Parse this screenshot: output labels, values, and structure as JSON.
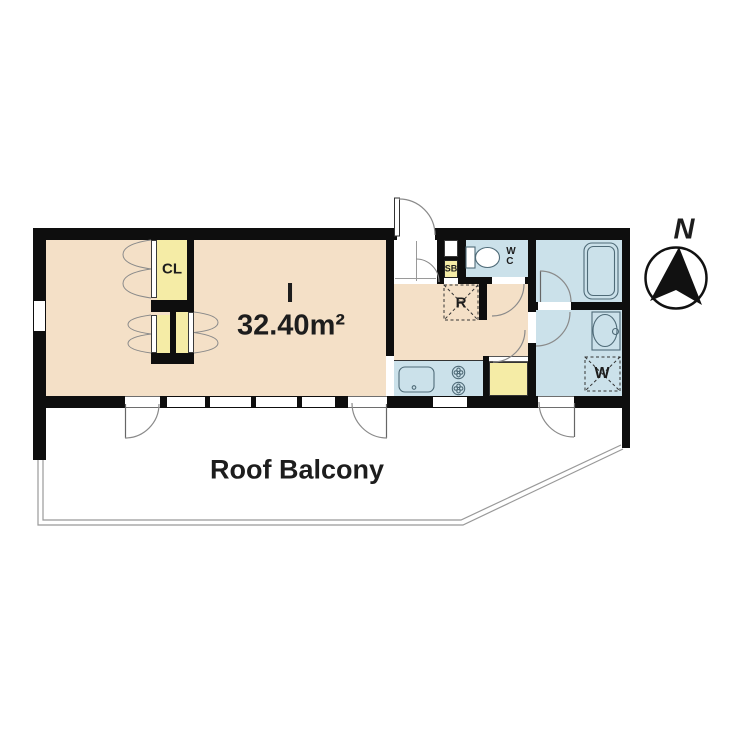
{
  "floor_plan": {
    "unit": {
      "type_label": "I",
      "area_label": "32.40m²"
    },
    "closet": {
      "label": "CL"
    },
    "shoe_box": {
      "label": "SB"
    },
    "toilet_room": {
      "label_line1": "W",
      "label_line2": "C"
    },
    "refrigerator_space": {
      "label": "R"
    },
    "washer_space": {
      "label": "W"
    },
    "balcony": {
      "label": "Roof Balcony"
    },
    "compass": {
      "label": "N"
    }
  },
  "colors": {
    "room_fill": "#f4e0c7",
    "wet_fill": "#cbe1ea",
    "storage_fill": "#f5eca6",
    "wall_color": "#0e0e0e",
    "door_line": "#8a8a8a",
    "fixture_line": "#4f6b78",
    "dash_line": "#333333",
    "balcony_line": "#999999",
    "text_color": "#1d1d1d"
  }
}
